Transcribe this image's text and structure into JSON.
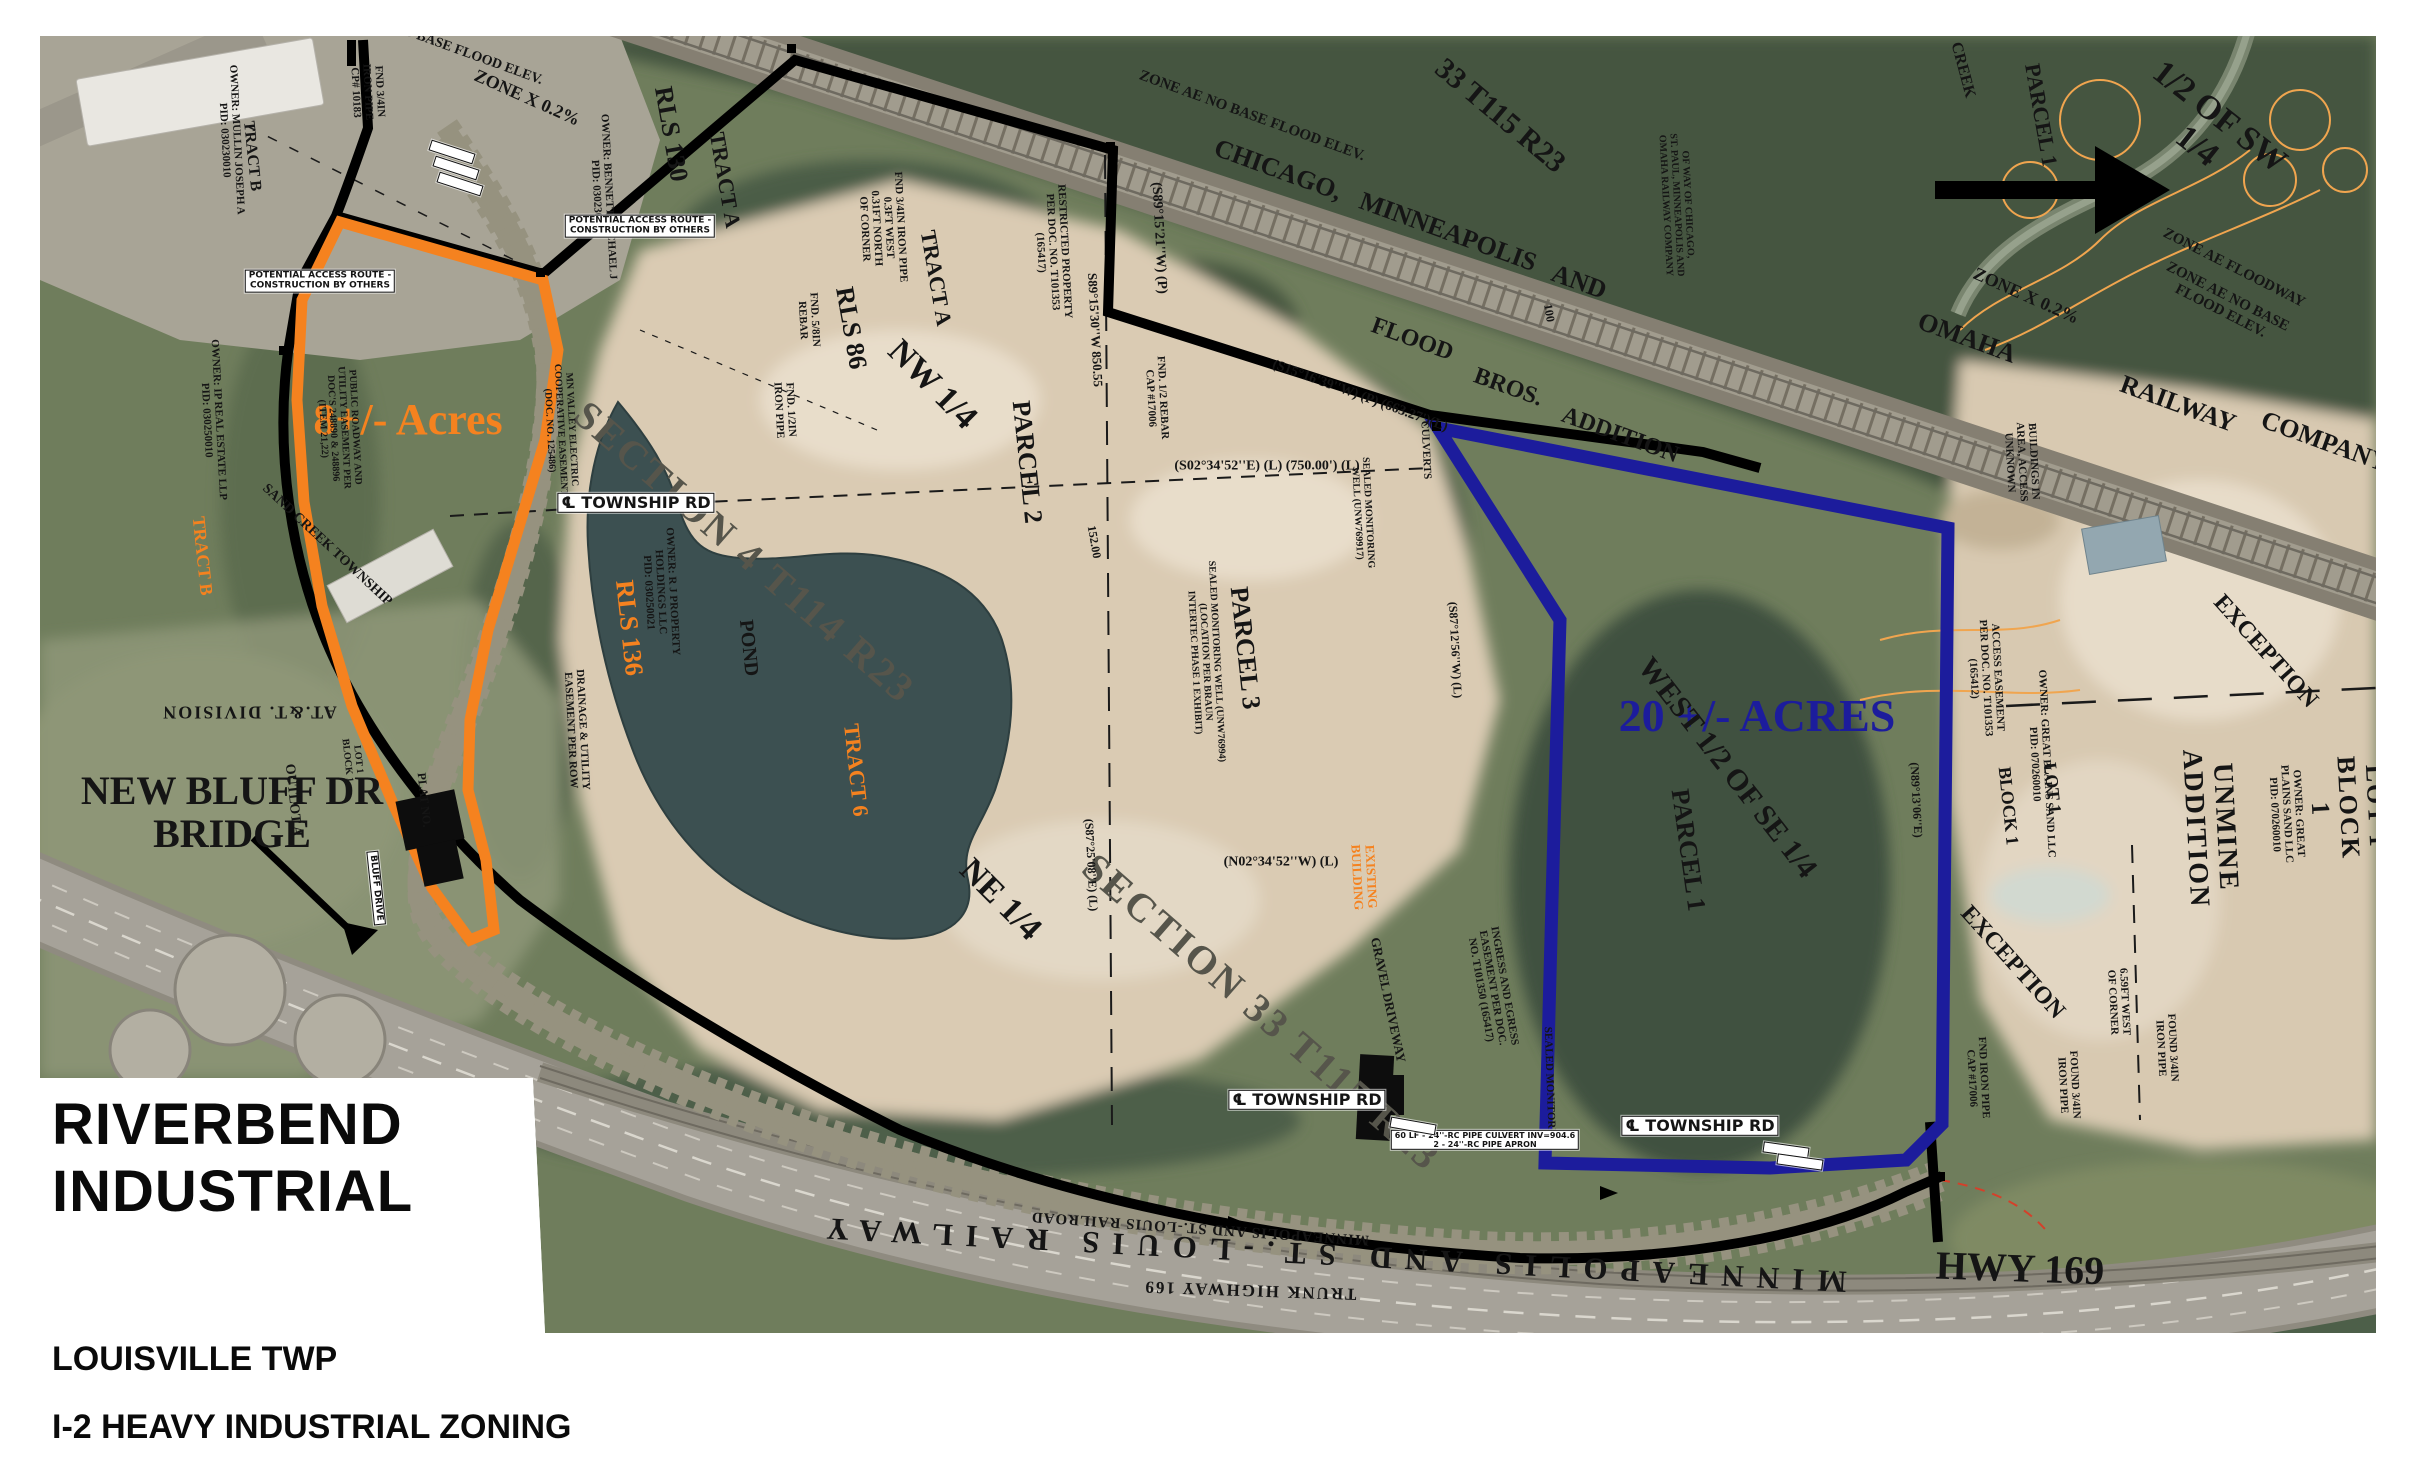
{
  "header": {
    "line1": "RIVERBEND",
    "line2": "INDUSTRIAL"
  },
  "footer": {
    "township": "LOUISVILLE TWP",
    "zoning": "I-2 HEAVY INDUSTRIAL ZONING"
  },
  "colors": {
    "black": "#151515",
    "orange": "#f5821f",
    "blue": "#1c1c9c",
    "gray": "#56554b",
    "red": "#c42408"
  },
  "map_labels": [
    {
      "n": "bridge-callout",
      "t": "NEW BLUFF DR\nBRIDGE",
      "x": 232,
      "y": 812,
      "r": 0,
      "s": 40,
      "w": 700
    },
    {
      "n": "acres-8-label",
      "t": "8+/- Acres",
      "x": 408,
      "y": 420,
      "r": 0,
      "s": 44,
      "c": "orange",
      "w": 700
    },
    {
      "n": "acres-20-label",
      "t": "20 +/- ACRES",
      "x": 1757,
      "y": 716,
      "r": 0,
      "s": 46,
      "c": "blue",
      "w": 700
    },
    {
      "n": "west-half-se",
      "t": "WEST 1/2 OF SE 1/4",
      "x": 1727,
      "y": 768,
      "r": 52,
      "s": 30
    },
    {
      "n": "parcel-1-blue",
      "t": "PARCEL 1",
      "x": 1688,
      "y": 850,
      "r": 82,
      "s": 26
    },
    {
      "n": "hwy-169-label",
      "t": "HWY 169",
      "x": 2020,
      "y": 1268,
      "r": 2,
      "s": 40,
      "w": 700
    },
    {
      "n": "section-4-label",
      "t": "SECTION 4 T114 R23",
      "x": 745,
      "y": 552,
      "r": 41,
      "s": 40,
      "c": "gray",
      "ls": 3
    },
    {
      "n": "section-33-label",
      "t": "SECTION 33 T115 R23",
      "x": 1262,
      "y": 1012,
      "r": 41,
      "s": 40,
      "c": "gray",
      "ls": 3
    },
    {
      "n": "nw-quarter",
      "t": "NW 1/4",
      "x": 932,
      "y": 385,
      "r": 45,
      "s": 34
    },
    {
      "n": "ne-quarter",
      "t": "NE 1/4",
      "x": 1000,
      "y": 900,
      "r": 45,
      "s": 34
    },
    {
      "n": "half-of-sw",
      "t": "1/2 OF SW 1/4",
      "x": 2208,
      "y": 132,
      "r": 38,
      "s": 34
    },
    {
      "n": "t115-r23",
      "t": "33 T115 R23",
      "x": 1500,
      "y": 116,
      "r": 40,
      "s": 30
    },
    {
      "n": "rr-chicago",
      "t": "CHICAGO,",
      "x": 1278,
      "y": 170,
      "r": 20,
      "s": 26
    },
    {
      "n": "rr-minneapolis",
      "t": "MINNEAPOLIS",
      "x": 1448,
      "y": 232,
      "r": 20,
      "s": 26
    },
    {
      "n": "rr-and",
      "t": "AND",
      "x": 1579,
      "y": 282,
      "r": 20,
      "s": 26
    },
    {
      "n": "rr-omaha",
      "t": "OMAHA",
      "x": 1967,
      "y": 338,
      "r": 20,
      "s": 26
    },
    {
      "n": "rr-railway",
      "t": "RAILWAY",
      "x": 2178,
      "y": 404,
      "r": 20,
      "s": 26
    },
    {
      "n": "rr-company",
      "t": "COMPANY",
      "x": 2325,
      "y": 442,
      "r": 20,
      "s": 26
    },
    {
      "n": "flood-label",
      "t": "FLOOD",
      "x": 1412,
      "y": 340,
      "r": 20,
      "s": 24
    },
    {
      "n": "bros-label",
      "t": "BROS.",
      "x": 1508,
      "y": 388,
      "r": 20,
      "s": 24
    },
    {
      "n": "addition-label",
      "t": "ADDITION",
      "x": 1620,
      "y": 436,
      "r": 20,
      "s": 24
    },
    {
      "n": "parcel-2-label",
      "t": "PARCEL 2",
      "x": 1027,
      "y": 462,
      "r": 84,
      "s": 26
    },
    {
      "n": "parcel-3-label",
      "t": "PARCEL 3",
      "x": 1245,
      "y": 648,
      "r": 84,
      "s": 26
    },
    {
      "n": "parcel-1-ne",
      "t": "PARCEL 1",
      "x": 2041,
      "y": 115,
      "r": 80,
      "s": 22
    },
    {
      "n": "creek-label",
      "t": "CREEK",
      "x": 1963,
      "y": 70,
      "r": 75,
      "s": 16
    },
    {
      "n": "pond-label",
      "t": "POND",
      "x": 748,
      "y": 648,
      "r": 84,
      "s": 20
    },
    {
      "n": "rls-136",
      "t": "RLS 136",
      "x": 629,
      "y": 628,
      "r": 84,
      "s": 26,
      "c": "orange"
    },
    {
      "n": "tract-6",
      "t": "TRACT 6",
      "x": 856,
      "y": 770,
      "r": 84,
      "s": 22,
      "c": "orange"
    },
    {
      "n": "tract-b-orange",
      "t": "TRACT B",
      "x": 202,
      "y": 556,
      "r": 84,
      "s": 18,
      "c": "orange"
    },
    {
      "n": "tract-b",
      "t": "TRACT B",
      "x": 252,
      "y": 156,
      "r": 84,
      "s": 16
    },
    {
      "n": "rls-130",
      "t": "RLS 130",
      "x": 671,
      "y": 134,
      "r": 80,
      "s": 26
    },
    {
      "n": "tract-a-1",
      "t": "TRACT A",
      "x": 725,
      "y": 180,
      "r": 80,
      "s": 22
    },
    {
      "n": "tract-a-2",
      "t": "TRACT A",
      "x": 936,
      "y": 278,
      "r": 80,
      "s": 22
    },
    {
      "n": "rls-86",
      "t": "RLS 86",
      "x": 851,
      "y": 328,
      "r": 80,
      "s": 26
    },
    {
      "n": "exception-1",
      "t": "EXCEPTION",
      "x": 2265,
      "y": 652,
      "r": 48,
      "s": 24
    },
    {
      "n": "exception-2",
      "t": "EXCEPTION",
      "x": 2012,
      "y": 963,
      "r": 48,
      "s": 24
    },
    {
      "n": "unmine-addition",
      "t": "UNMINE ADDITION",
      "x": 2210,
      "y": 828,
      "r": 87,
      "s": 28,
      "ls": 2
    },
    {
      "n": "lot1-block1-east",
      "t": "LOT 1 BLOCK 1",
      "x": 2348,
      "y": 808,
      "r": 87,
      "s": 26,
      "ls": 2
    },
    {
      "n": "lot-1",
      "t": "LOT 1",
      "x": 2052,
      "y": 788,
      "r": 84,
      "s": 18
    },
    {
      "n": "block-1",
      "t": "BLOCK 1",
      "x": 2008,
      "y": 806,
      "r": 84,
      "s": 18
    },
    {
      "n": "zone-x-1",
      "t": "ZONE X 0.2%",
      "x": 527,
      "y": 98,
      "r": 24,
      "s": 18
    },
    {
      "n": "zone-x-2",
      "t": "ZONE X 0.2%",
      "x": 2026,
      "y": 296,
      "r": 24,
      "s": 18
    },
    {
      "n": "zone-ae-floodway",
      "t": "ZONE AE FLOODWAY",
      "x": 2234,
      "y": 268,
      "r": 27,
      "s": 15
    },
    {
      "n": "zone-ae-1",
      "t": "ZONE AE NO BASE FLOOD ELEV.",
      "x": 2224,
      "y": 304,
      "r": 27,
      "s": 15
    },
    {
      "n": "zone-ae-2",
      "t": "ZONE AE NO BASE FLOOD ELEV.",
      "x": 1252,
      "y": 116,
      "r": 20,
      "s": 15
    },
    {
      "n": "base-flood-elev",
      "t": "NO BASE FLOOD ELEV.",
      "x": 468,
      "y": 54,
      "r": 20,
      "s": 14
    },
    {
      "n": "rr-right-of-way",
      "t": "OF WAY OF CHICAGO,\nST. PAUL, MINNEAPOLIS AND\nOMAHA RAILWAY COMPANY",
      "x": 1676,
      "y": 205,
      "r": 87,
      "s": 10
    },
    {
      "n": "brg-s89-15-21",
      "t": "(S89°15'21''W) (P)",
      "x": 1159,
      "y": 238,
      "r": 87,
      "s": 14
    },
    {
      "n": "brg-s89-15-30",
      "t": "S89°15'30''W  850.55",
      "x": 1095,
      "y": 330,
      "r": 87,
      "s": 13
    },
    {
      "n": "brg-s15-16-39",
      "t": "(S15°16'39''W) (P) (663.27')(L)",
      "x": 1360,
      "y": 396,
      "r": 20,
      "s": 14
    },
    {
      "n": "brg-s02-34-52",
      "t": "(S02°34'52''E) (L) (750.00') (L)",
      "x": 1267,
      "y": 466,
      "r": 0,
      "s": 14
    },
    {
      "n": "brg-n02-34-52",
      "t": "(N02°34'52''W) (L)",
      "x": 1281,
      "y": 862,
      "r": 0,
      "s": 14
    },
    {
      "n": "brg-s87-12-56",
      "t": "(S87°12'56''W) (L)",
      "x": 1455,
      "y": 650,
      "r": 87,
      "s": 12
    },
    {
      "n": "brg-s87-25-08",
      "t": "(S87°25'08''E) (L)",
      "x": 1091,
      "y": 865,
      "r": 87,
      "s": 12
    },
    {
      "n": "brg-n89-13-06",
      "t": "(N89°13'06''E)",
      "x": 1916,
      "y": 800,
      "r": 87,
      "s": 12
    },
    {
      "n": "dim-100",
      "t": "100",
      "x": 1549,
      "y": 313,
      "r": 80,
      "s": 12
    },
    {
      "n": "dim-152",
      "t": "152.00",
      "x": 1094,
      "y": 542,
      "r": 80,
      "s": 12
    },
    {
      "n": "fnd-rebar-17006",
      "t": "FND. 1/2 REBAR\nCAP #17006",
      "x": 1156,
      "y": 398,
      "r": 87,
      "s": 11
    },
    {
      "n": "fnd-half-pipe",
      "t": "FND. 1/2IN\nIRON PIPE",
      "x": 784,
      "y": 410,
      "r": 87,
      "s": 11
    },
    {
      "n": "fnd-34-pipe",
      "t": "FND 3/4IN IRON PIPE\n0.3FT WEST\n0.31FT NORTH\nOF CORNER",
      "x": 882,
      "y": 228,
      "r": 87,
      "s": 11
    },
    {
      "n": "fnd-58-rebar",
      "t": "FND. 5/8IN\nREBAR",
      "x": 808,
      "y": 320,
      "r": 87,
      "s": 11
    },
    {
      "n": "fnd-34-cp10183",
      "t": "FND 3/4IN\nIRON PIPE\nCP# 10183",
      "x": 367,
      "y": 92,
      "r": 87,
      "s": 11
    },
    {
      "n": "found-34-pipe-1",
      "t": "FOUND 3/4IN\nIRON PIPE",
      "x": 2166,
      "y": 1048,
      "r": 87,
      "s": 11
    },
    {
      "n": "found-34-pipe-2",
      "t": "FOUND 3/4IN\nIRON PIPE",
      "x": 2068,
      "y": 1085,
      "r": 87,
      "s": 11
    },
    {
      "n": "fnd-pipe-17006",
      "t": "FND IRON PIPE\nCAP #17006",
      "x": 1977,
      "y": 1078,
      "r": 87,
      "s": 11
    },
    {
      "n": "west-of-corner",
      "t": "6.59FT WEST\nOF CORNER",
      "x": 2118,
      "y": 1002,
      "r": 87,
      "s": 11
    },
    {
      "n": "restricted-property",
      "t": "RESTRICTED PROPERTY\nPER DOC. NO. T101353\n(165417)",
      "x": 1052,
      "y": 252,
      "r": 87,
      "s": 11
    },
    {
      "n": "ingress-egress",
      "t": "INGRESS AND EGRESS\nEASEMENT PER DOC.\nNO. T101350 (165417)",
      "x": 1492,
      "y": 988,
      "r": 80,
      "s": 11
    },
    {
      "n": "access-easement",
      "t": "ACCESS EASEMENT\nPER DOC. NO. T101353\n(165412)",
      "x": 1985,
      "y": 678,
      "r": 87,
      "s": 11
    },
    {
      "n": "owner-great-plains-1",
      "t": "OWNER: GREAT PLAINS SAND LLC\nPID: 070260010",
      "x": 2040,
      "y": 764,
      "r": 87,
      "s": 11
    },
    {
      "n": "owner-great-plains-2",
      "t": "OWNER: GREAT PLAINS SAND LLC\nPID: 070260010",
      "x": 2286,
      "y": 814,
      "r": 87,
      "s": 11
    },
    {
      "n": "owner-bennett",
      "t": "OWNER: BENNETT MICHAEL J\nPID: 030230010",
      "x": 602,
      "y": 197,
      "r": 87,
      "s": 11
    },
    {
      "n": "owner-mullin",
      "t": "OWNER: MULLIN JOSEPH A\nPID: 030230010",
      "x": 230,
      "y": 140,
      "r": 87,
      "s": 11
    },
    {
      "n": "owner-rj-property",
      "t": "OWNER: R J PROPERTY\nHOLDINGS LLC\nPID: 030250021",
      "x": 660,
      "y": 592,
      "r": 87,
      "s": 11
    },
    {
      "n": "owner-real-estate",
      "t": "OWNER: IP REAL ESTATE LLP\nPID: 030250010",
      "x": 212,
      "y": 420,
      "r": 87,
      "s": 11
    },
    {
      "n": "public-roadway-easement",
      "t": "PUBLIC ROADWAY AND\nUTILITY EASEMENT PER\nDOC'S 248890 & 248896\n(ITEM 21,22)",
      "x": 338,
      "y": 428,
      "r": 87,
      "s": 10
    },
    {
      "n": "mn-valley-easement",
      "t": "MN VALLEY ELECTRIC\nCOOPERATIVE EASEMENT\n(DOC. NO. 125486)",
      "x": 560,
      "y": 430,
      "r": 87,
      "s": 10
    },
    {
      "n": "potential-access-1",
      "t": "POTENTIAL ACCESS ROUTE -\nCONSTRUCTION BY OTHERS",
      "x": 640,
      "y": 226,
      "r": 0,
      "s": 9,
      "chip": true
    },
    {
      "n": "potential-access-2",
      "t": "POTENTIAL ACCESS ROUTE -\nCONSTRUCTION BY OTHERS",
      "x": 320,
      "y": 281,
      "r": 0,
      "s": 9,
      "chip": true
    },
    {
      "n": "township-rd-1",
      "t": "℄ TOWNSHIP RD",
      "x": 636,
      "y": 503,
      "r": 0,
      "s": 16,
      "chip": true,
      "w": 700
    },
    {
      "n": "township-rd-2",
      "t": "℄ TOWNSHIP RD",
      "x": 1307,
      "y": 1100,
      "r": 0,
      "s": 16,
      "chip": true,
      "w": 700
    },
    {
      "n": "township-rd-3",
      "t": "℄ TOWNSHIP RD",
      "x": 1700,
      "y": 1126,
      "r": 0,
      "s": 16,
      "chip": true,
      "w": 700
    },
    {
      "n": "bluff-drive",
      "t": "BLUFF DRIVE",
      "x": 376,
      "y": 888,
      "r": 84,
      "s": 9,
      "chip": true
    },
    {
      "n": "outlot-a",
      "t": "OUTLOT A",
      "x": 293,
      "y": 800,
      "r": 84,
      "s": 14
    },
    {
      "n": "lot1-block1-west",
      "t": "LOT 1\nBLOCK 1",
      "x": 352,
      "y": 760,
      "r": 84,
      "s": 10
    },
    {
      "n": "plat-no",
      "t": "PLAT NO.",
      "x": 424,
      "y": 800,
      "r": 84,
      "s": 12
    },
    {
      "n": "sand-creek-township",
      "t": "SAND CREEK TOWNSHIP",
      "x": 327,
      "y": 545,
      "r": 43,
      "s": 14
    },
    {
      "n": "att-division",
      "t": "AT.&T. DIVISION",
      "x": 249,
      "y": 712,
      "r": 180,
      "s": 18,
      "ls": 2
    },
    {
      "n": "drainage-easement",
      "t": "DRAINAGE & UTILITY\nEASEMENT PER ROW",
      "x": 576,
      "y": 730,
      "r": 87,
      "s": 11
    },
    {
      "n": "gravel-driveway",
      "t": "GRAVEL DRIVEWAY",
      "x": 1388,
      "y": 1000,
      "r": 78,
      "s": 13
    },
    {
      "n": "existing-building",
      "t": "EXISTING\nBUILDING",
      "x": 1364,
      "y": 877,
      "r": 87,
      "s": 13,
      "c": "orange"
    },
    {
      "n": "buildings-unknown",
      "t": "BUILDINGS IN\nAREA, ACCESS\nUNKNOWN",
      "x": 2021,
      "y": 462,
      "r": 87,
      "s": 11
    },
    {
      "n": "sealed-well-1",
      "t": "SEALED MONITORING\nWELL (UNW769917)",
      "x": 1362,
      "y": 513,
      "r": 87,
      "s": 10
    },
    {
      "n": "sealed-well-2",
      "t": "SEALED MONITORING WELL (UNW76994)\n(LOCATION PER BRAUN\nINTERTEC PHASE 1 EXHIBIT)",
      "x": 1205,
      "y": 662,
      "r": 87,
      "s": 10
    },
    {
      "n": "sealed-well-3",
      "t": "SEALED MONITORING",
      "x": 1549,
      "y": 1088,
      "r": 88,
      "s": 11
    },
    {
      "n": "culverts",
      "t": "CULVERTS",
      "x": 1425,
      "y": 450,
      "r": 87,
      "s": 11
    },
    {
      "n": "culvert-note",
      "t": "60 LF - 24''-RC PIPE CULVERT INV=904.6\n2 - 24''-RC PIPE APRON",
      "x": 1485,
      "y": 1140,
      "r": 0,
      "s": 8,
      "chip": true
    },
    {
      "n": "rr-mstl-small",
      "t": "MINNEAPOLIS AND ST.-LOUIS RAILROAD",
      "x": 1200,
      "y": 1228,
      "r": 184,
      "s": 15,
      "ls": 1
    },
    {
      "n": "rr-mstl-big",
      "t": "MINNEAPOLIS AND ST.-LOUIS RAILWAY",
      "x": 1330,
      "y": 1255,
      "r": 183,
      "s": 31,
      "ls": 13
    },
    {
      "n": "trunk-highway-169",
      "t": "TRUNK HIGHWAY 169",
      "x": 1250,
      "y": 1290,
      "r": 182,
      "s": 17,
      "ls": 2
    },
    {
      "n": "station-chip-1",
      "t": "",
      "x": 452,
      "y": 152,
      "r": 18,
      "chip": true
    },
    {
      "n": "station-chip-2",
      "t": "",
      "x": 456,
      "y": 168,
      "r": 18,
      "chip": true
    },
    {
      "n": "station-chip-3",
      "t": "",
      "x": 460,
      "y": 184,
      "r": 18,
      "chip": true
    },
    {
      "n": "station-chip-4",
      "t": "",
      "x": 1786,
      "y": 1150,
      "r": 8,
      "chip": true
    },
    {
      "n": "station-chip-5",
      "t": "",
      "x": 1800,
      "y": 1162,
      "r": 8,
      "chip": true
    },
    {
      "n": "station-chip-6",
      "t": "",
      "x": 1413,
      "y": 1126,
      "r": 10,
      "chip": true
    }
  ]
}
